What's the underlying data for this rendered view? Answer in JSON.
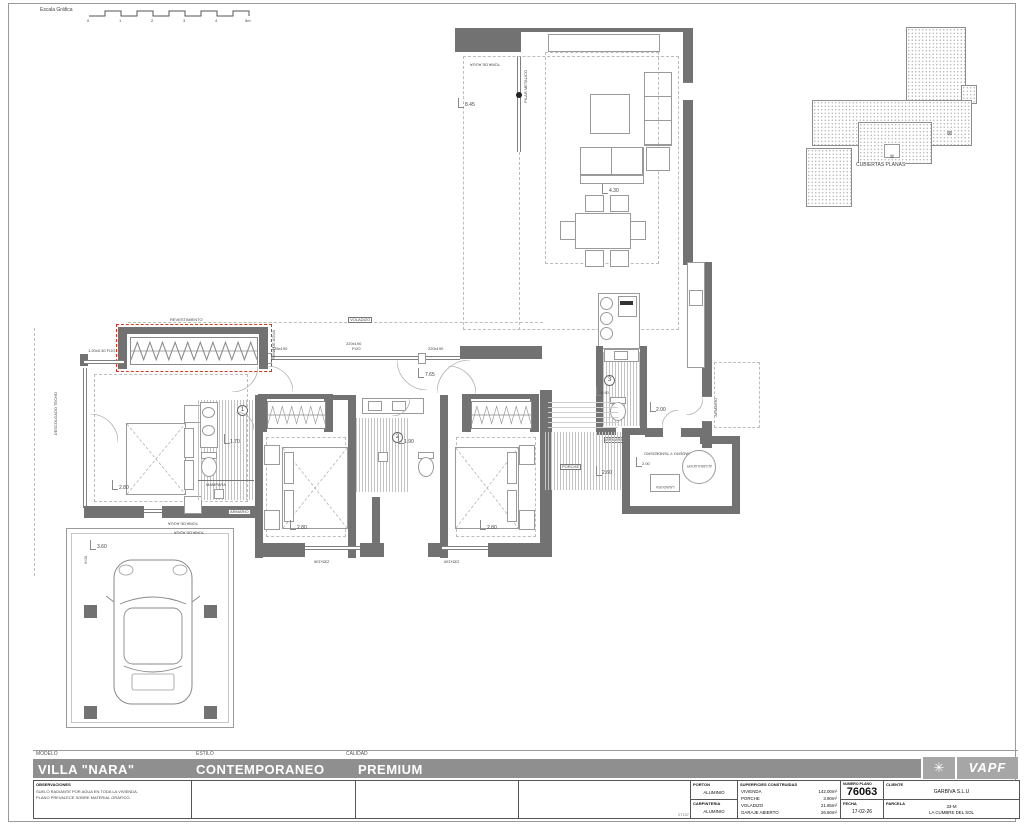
{
  "scale_bar": {
    "label": "Escala Gráfica",
    "ticks": [
      "0",
      "1",
      "2",
      "3",
      "4",
      "5m"
    ]
  },
  "roof": {
    "label": "CUBIERTAS PLANAS"
  },
  "icons": {
    "sun": "✳",
    "pillar_box": "⊠"
  },
  "plan": {
    "labels": {
      "toma_de_agua": "TOMA DE AGUA",
      "pilar_metalico": "PILAR METALICO",
      "voladizo": "VOLADIZO",
      "revestimiento": "REVESTIMIENTO",
      "mampara": "MAMPARA",
      "porche": "PORCHE",
      "armario": "ARMARIO",
      "lavadora": "LAVADORA",
      "acumulador": "ACUMULADOR",
      "lavadero": "LAVADERO Y TENDEDERO",
      "descolgado": "DESCOLGADO TECHO",
      "bath1": "1",
      "bath2": "2",
      "bath3": "3"
    },
    "windows": {
      "fijo_small": "1.20x0.30 FIJO",
      "w235": "235x190",
      "w220": "220x190",
      "fijo": "FIJO"
    },
    "dims": {
      "d845": "8.45",
      "d430": "4.30",
      "d765": "7.65",
      "d280": "2.80",
      "d170": "1.70",
      "d190": "1.90",
      "d090": "0.90",
      "d200": "2.00",
      "d260": "2.60",
      "d360": "3.60",
      "d600": "6.00"
    }
  },
  "title_block": {
    "modelo_label": "MODELO",
    "modelo": "VILLA \"NARA\"",
    "estilo_label": "ESTILO",
    "estilo": "CONTEMPORANEO",
    "calidad_label": "CALIDAD",
    "calidad": "PREMIUM",
    "observaciones_label": "OBSERVACIONES",
    "observaciones_1": "SUELO RADIANTE POR AGUA EN TODA LA VIVIENDA.",
    "observaciones_2": "PLANO PREVALECE SOBRE MATERIAL GRÁFICO.",
    "doc_number": "27137",
    "porton_label": "PORTON",
    "porton": "ALUMINIO",
    "carpinteria_label": "CARPINTERIA",
    "carpinteria": "ALUMINIO",
    "superficies_label": "SUPERFICIES CONSTRUIDAS",
    "superficies": [
      {
        "name": "VIVIENDA",
        "value": "142.00m²"
      },
      {
        "name": "PORCHE",
        "value": "3.90m²"
      },
      {
        "name": "VOLADIZO",
        "value": "21.65m²"
      },
      {
        "name": "GARAJE ABIERTO",
        "value": "26.60m²"
      }
    ],
    "numero_plano_label": "NUMERO PLANO",
    "numero_plano": "76063",
    "fecha_label": "FECHA",
    "fecha": "17-02-26",
    "cliente_label": "CLIENTE",
    "cliente": "GARBIVA S.L.U",
    "parcela_label": "PARCELA",
    "parcela_line1": "33-M",
    "parcela_line2": "LA CUMBRE DEL SOL",
    "logo_text": "VAPF"
  }
}
